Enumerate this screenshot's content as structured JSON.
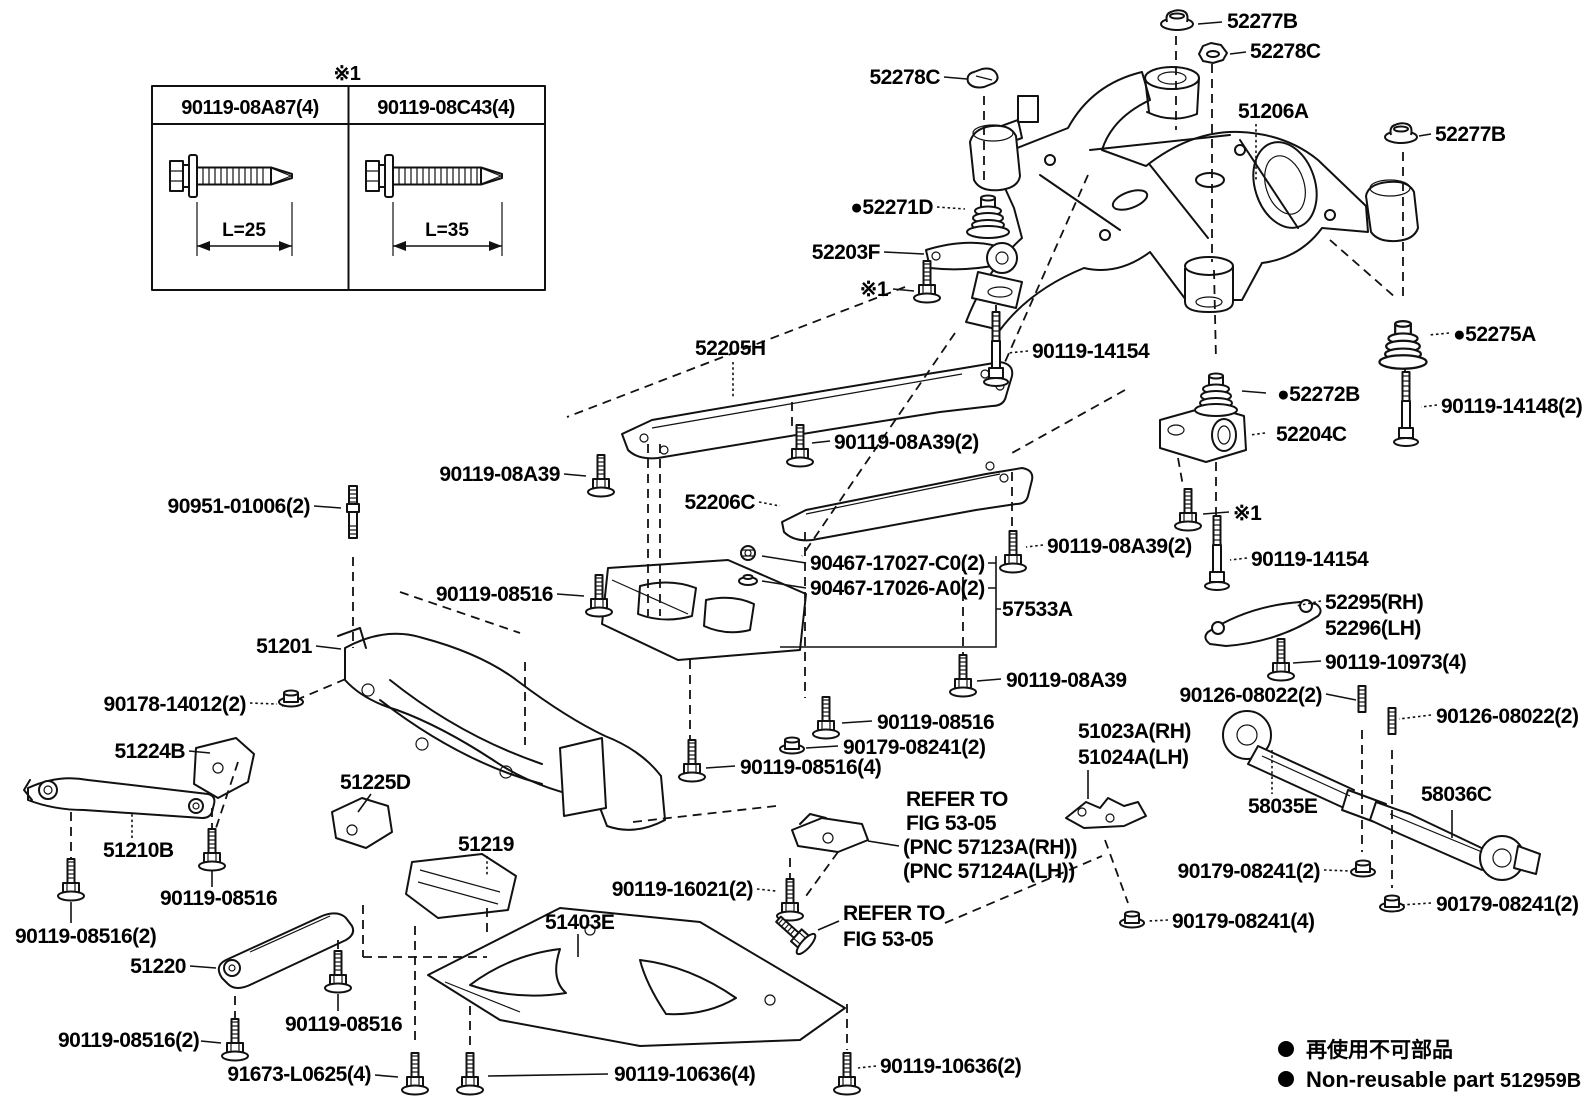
{
  "page": {
    "background": "#ffffff",
    "ink": "#111111"
  },
  "note_table": {
    "note": "※1",
    "columns": [
      {
        "part_number": "90119-08A87(4)",
        "length": "L=25"
      },
      {
        "part_number": "90119-08C43(4)",
        "length": "L=35"
      }
    ]
  },
  "legend": {
    "jp": "再使用不可部品",
    "en": "Non-reusable part",
    "figure_code": "512959B"
  },
  "labels": [
    {
      "t": "52277B",
      "x": 1227,
      "y": 28,
      "a": "start"
    },
    {
      "t": "52278C",
      "x": 1250,
      "y": 58,
      "a": "start"
    },
    {
      "t": "52278C",
      "x": 940,
      "y": 84,
      "a": "end"
    },
    {
      "t": "51206A",
      "x": 1238,
      "y": 118,
      "a": "start"
    },
    {
      "t": "52277B",
      "x": 1435,
      "y": 141,
      "a": "start"
    },
    {
      "t": "52271D",
      "x": 933,
      "y": 214,
      "a": "end",
      "b": true
    },
    {
      "t": "52203F",
      "x": 880,
      "y": 259,
      "a": "end"
    },
    {
      "t": "※1",
      "x": 888,
      "y": 296,
      "a": "end"
    },
    {
      "t": "90119-14154",
      "x": 1032,
      "y": 358,
      "a": "start"
    },
    {
      "t": "52205H",
      "x": 695,
      "y": 355,
      "a": "start"
    },
    {
      "t": "90119-08A39",
      "x": 560,
      "y": 481,
      "a": "end"
    },
    {
      "t": "52206C",
      "x": 755,
      "y": 509,
      "a": "end"
    },
    {
      "t": "90119-08516",
      "x": 553,
      "y": 601,
      "a": "end"
    },
    {
      "t": "90951-01006(2)",
      "x": 310,
      "y": 513,
      "a": "end"
    },
    {
      "t": "51201",
      "x": 312,
      "y": 653,
      "a": "end"
    },
    {
      "t": "90178-14012(2)",
      "x": 246,
      "y": 711,
      "a": "end"
    },
    {
      "t": "51224B",
      "x": 185,
      "y": 758,
      "a": "end"
    },
    {
      "t": "51210B",
      "x": 103,
      "y": 857,
      "a": "start"
    },
    {
      "t": "90119-08516",
      "x": 160,
      "y": 905,
      "a": "start"
    },
    {
      "t": "90119-08516(2)",
      "x": 15,
      "y": 943,
      "a": "start"
    },
    {
      "t": "51220",
      "x": 186,
      "y": 973,
      "a": "end"
    },
    {
      "t": "90119-08516",
      "x": 285,
      "y": 1031,
      "a": "start"
    },
    {
      "t": "90119-08516(2)",
      "x": 58,
      "y": 1047,
      "a": "start"
    },
    {
      "t": "91673-L0625(4)",
      "x": 371,
      "y": 1081,
      "a": "end"
    },
    {
      "t": "51225D",
      "x": 340,
      "y": 789,
      "a": "start"
    },
    {
      "t": "51219",
      "x": 458,
      "y": 851,
      "a": "start"
    },
    {
      "t": "51403E",
      "x": 545,
      "y": 929,
      "a": "start"
    },
    {
      "t": "90119-16021(2)",
      "x": 753,
      "y": 896,
      "a": "end"
    },
    {
      "t": "REFER TO",
      "x": 843,
      "y": 920,
      "a": "start"
    },
    {
      "t": "FIG 53-05",
      "x": 843,
      "y": 946,
      "a": "start"
    },
    {
      "t": "90119-10636(4)",
      "x": 614,
      "y": 1081,
      "a": "start"
    },
    {
      "t": "90119-10636(2)",
      "x": 880,
      "y": 1073,
      "a": "start"
    },
    {
      "t": "90467-17027-C0(2)",
      "x": 810,
      "y": 570,
      "a": "start"
    },
    {
      "t": "90467-17026-A0(2)",
      "x": 810,
      "y": 595,
      "a": "start"
    },
    {
      "t": "57533A",
      "x": 1002,
      "y": 616,
      "a": "start"
    },
    {
      "t": "90119-08A39(2)",
      "x": 834,
      "y": 449,
      "a": "start"
    },
    {
      "t": "90119-08A39(2)",
      "x": 1047,
      "y": 553,
      "a": "start"
    },
    {
      "t": "90119-08A39",
      "x": 1006,
      "y": 687,
      "a": "start"
    },
    {
      "t": "90119-08516",
      "x": 877,
      "y": 729,
      "a": "start"
    },
    {
      "t": "90179-08241(2)",
      "x": 843,
      "y": 754,
      "a": "start"
    },
    {
      "t": "90119-08516(4)",
      "x": 740,
      "y": 774,
      "a": "start"
    },
    {
      "t": "51023A(RH)",
      "x": 1078,
      "y": 738,
      "a": "start"
    },
    {
      "t": "51024A(LH)",
      "x": 1078,
      "y": 764,
      "a": "start"
    },
    {
      "t": "REFER TO",
      "x": 906,
      "y": 806,
      "a": "start"
    },
    {
      "t": "FIG 53-05",
      "x": 906,
      "y": 830,
      "a": "start"
    },
    {
      "t": "(PNC 57123A(RH))",
      "x": 903,
      "y": 854,
      "a": "start"
    },
    {
      "t": "(PNC 57124A(LH))",
      "x": 903,
      "y": 878,
      "a": "start"
    },
    {
      "t": "90179-08241(4)",
      "x": 1172,
      "y": 928,
      "a": "start"
    },
    {
      "t": "※1",
      "x": 1233,
      "y": 520,
      "a": "start"
    },
    {
      "t": "90119-14154",
      "x": 1251,
      "y": 566,
      "a": "start"
    },
    {
      "t": "52295(RH)",
      "x": 1325,
      "y": 609,
      "a": "start"
    },
    {
      "t": "52296(LH)",
      "x": 1325,
      "y": 635,
      "a": "start"
    },
    {
      "t": "90119-10973(4)",
      "x": 1325,
      "y": 669,
      "a": "start"
    },
    {
      "t": "90126-08022(2)",
      "x": 1322,
      "y": 702,
      "a": "end"
    },
    {
      "t": "90126-08022(2)",
      "x": 1436,
      "y": 723,
      "a": "start"
    },
    {
      "t": "58035E",
      "x": 1248,
      "y": 813,
      "a": "start"
    },
    {
      "t": "58036C",
      "x": 1421,
      "y": 801,
      "a": "start"
    },
    {
      "t": "90179-08241(2)",
      "x": 1320,
      "y": 878,
      "a": "end"
    },
    {
      "t": "90179-08241(2)",
      "x": 1436,
      "y": 911,
      "a": "start"
    },
    {
      "t": "52275A",
      "x": 1453,
      "y": 341,
      "a": "start",
      "b": true
    },
    {
      "t": "90119-14148(2)",
      "x": 1441,
      "y": 413,
      "a": "start"
    },
    {
      "t": "52272B",
      "x": 1277,
      "y": 401,
      "a": "start",
      "b": true
    },
    {
      "t": "52204C",
      "x": 1276,
      "y": 441,
      "a": "start"
    }
  ]
}
